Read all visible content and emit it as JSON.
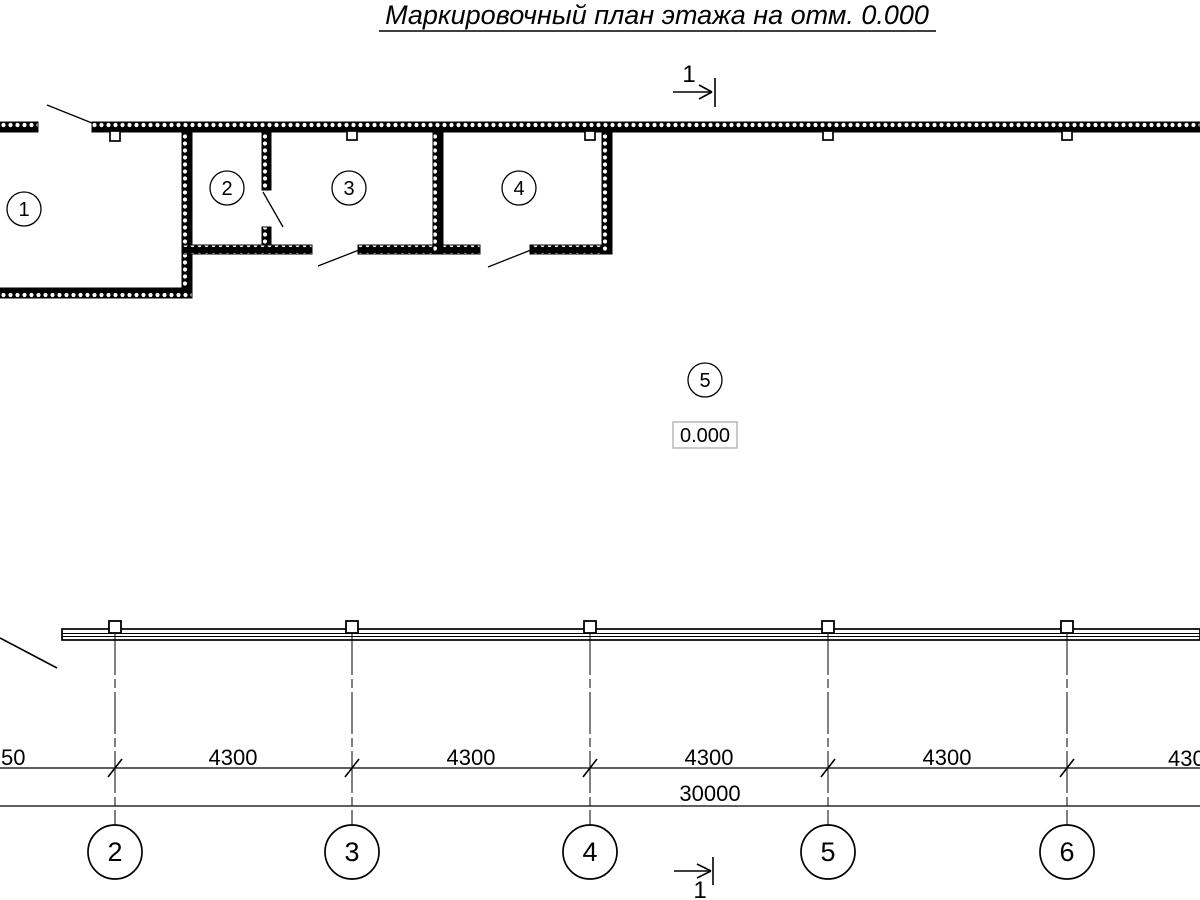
{
  "title": "Маркировочный план этажа на отм. 0.000",
  "section_marker": {
    "label": "1"
  },
  "plan": {
    "rooms": [
      {
        "number": "1"
      },
      {
        "number": "2"
      },
      {
        "number": "3"
      },
      {
        "number": "4"
      },
      {
        "number": "5"
      }
    ],
    "elevation": "0.000"
  },
  "dimensions": {
    "segments": [
      "50",
      "4300",
      "4300",
      "4300",
      "4300",
      "430"
    ],
    "total": "30000"
  },
  "axes": [
    "2",
    "3",
    "4",
    "5",
    "6"
  ],
  "colors": {
    "line": "#000000",
    "elevation_box_border": "#b3b3b3"
  }
}
